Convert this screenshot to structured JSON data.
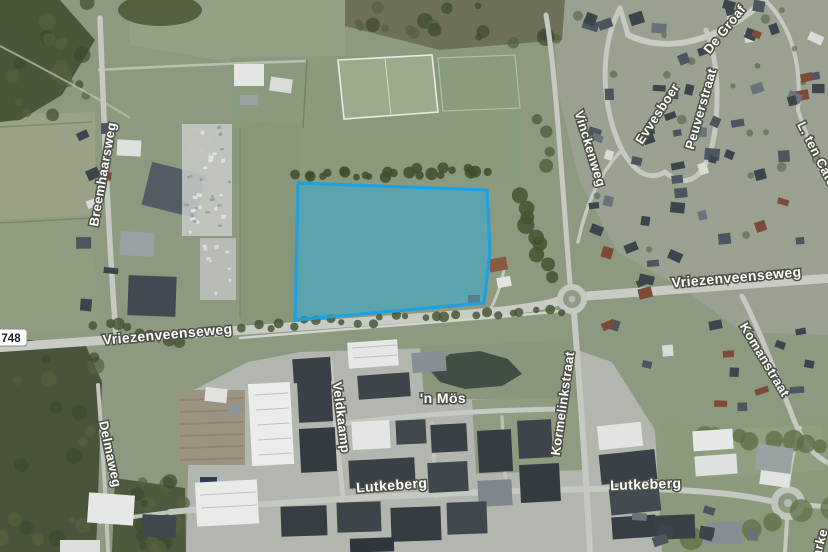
{
  "map": {
    "view": "aerial-satellite",
    "road_shield": {
      "label": "748"
    },
    "street_labels": {
      "breemhaarsweg": "Breemhaarsweg",
      "vriezenveenseweg_west": "Vriezenveenseweg",
      "vriezenveenseweg_east": "Vriezenveenseweg",
      "vinckenweg": "Vinckenweg",
      "evvesboer": "Evvesboer",
      "peuverstraat": "Peuverstraat",
      "de_groaf": "De Groaf",
      "l_ten_cate": "L. ten Cate",
      "komanstraat": "Komanstraat",
      "kormelinkstraat": "Kormelinkstraat",
      "veldkaamp": "Veldkaamp",
      "n_mos": "'n Mös",
      "lutkeberg_west": "Lutkeberg",
      "lutkeberg_east": "Lutkeberg",
      "delmaweg": "Delmaweg",
      "edge_fragment": "arke"
    },
    "highlight": {
      "label": "selected-parcel",
      "stroke_color": "#1ea1dd",
      "fill_color": "rgba(45,173,226,0.5)",
      "stroke_width": 3.2,
      "points": "298,183 487,190 490,252 484,303 295,320"
    }
  }
}
